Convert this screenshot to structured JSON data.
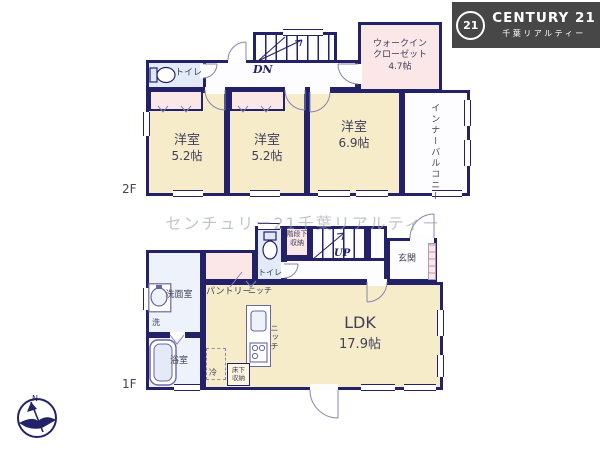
{
  "colors": {
    "wall": "#232269",
    "room_fill": "#f6ecca",
    "closet_fill": "#fbe7e8",
    "wet_area_fill": "#e2ebf7",
    "logo_bg": "#474747",
    "watermark": "#969cac"
  },
  "brand": {
    "badge": "21",
    "name": "CENTURY 21",
    "subtitle": "千葉リアルティー"
  },
  "watermark_text": "センチュリー21千葉リアルティー",
  "compass": {
    "north": "N"
  },
  "f2": {
    "floor_label": "2F",
    "toilet_label": "トイレ",
    "stairs_label": "DN",
    "wic": {
      "line1": "ウォークイン",
      "line2": "クローゼット",
      "size": "4.7帖"
    },
    "room1": {
      "name": "洋室",
      "size": "5.2帖"
    },
    "room2": {
      "name": "洋室",
      "size": "5.2帖"
    },
    "room3": {
      "name": "洋室",
      "size": "6.9帖"
    },
    "balcony_label": "インナーバルコニー"
  },
  "f1": {
    "floor_label": "1F",
    "pantry_label": "パントリー",
    "niche_top_label": "ニッチ",
    "niche_side_label": "ニッチ",
    "toilet_label": "トイレ",
    "understairs": {
      "line1": "階段下",
      "line2": "収納"
    },
    "stairs_label": "UP",
    "entrance_label": "玄関",
    "washroom_label": "洗面室",
    "laundry_label": "洗",
    "bathroom_label": "浴室",
    "ldk": {
      "name": "LDK",
      "size": "17.9帖"
    },
    "fridge_label": "冷",
    "underfloor": {
      "line1": "床下",
      "line2": "収納"
    }
  }
}
